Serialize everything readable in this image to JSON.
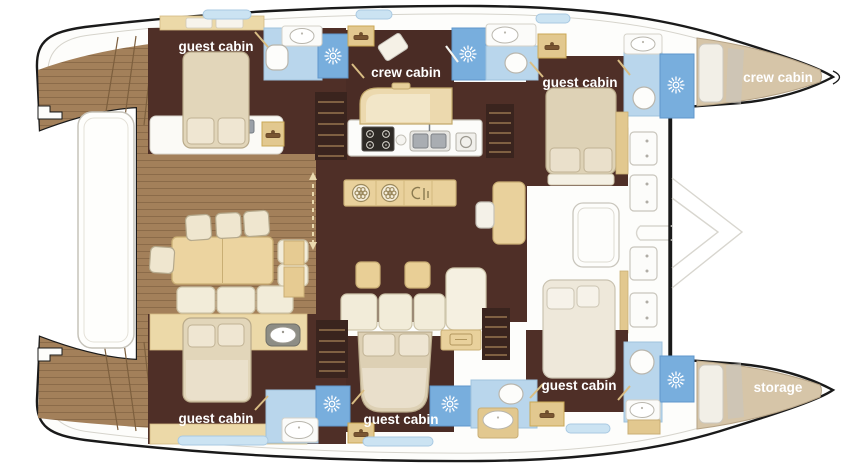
{
  "plan": {
    "type": "catamaran-deck-floorplan",
    "labels": [
      {
        "id": "guest-cabin-aft-port",
        "text": "guest cabin"
      },
      {
        "id": "crew-cabin-mid-port",
        "text": "crew cabin"
      },
      {
        "id": "guest-cabin-fwd-port",
        "text": "guest cabin"
      },
      {
        "id": "crew-cabin-bow-port",
        "text": "crew cabin"
      },
      {
        "id": "guest-cabin-fwd-stbd",
        "text": "guest cabin"
      },
      {
        "id": "storage-bow-stbd",
        "text": "storage"
      },
      {
        "id": "guest-cabin-mid-stbd",
        "text": "guest cabin"
      },
      {
        "id": "guest-cabin-aft-stbd",
        "text": "guest cabin"
      }
    ],
    "icons": [
      "shower-icon",
      "sink-icon",
      "toilet-icon",
      "stove-icon",
      "galley-sink-icon",
      "appliance-icon",
      "hanger-icon",
      "hatch-icon",
      "drawer-icon"
    ],
    "colors": {
      "hull_outline": "#1a1a1a",
      "deck_wood": "#a3805a",
      "wood_plank_line": "#8b6b49",
      "cabin_floor": "#4f2f27",
      "wall_tan": "#e6cb92",
      "furniture_tan": "#e9d19c",
      "bed_cream": "#e2d6ba",
      "pillow_cream": "#efe6d2",
      "bath_light_blue": "#b9d6ec",
      "shower_blue": "#78aedd",
      "window_blue": "#cbe3f2",
      "label_text": "#ffffff"
    }
  }
}
